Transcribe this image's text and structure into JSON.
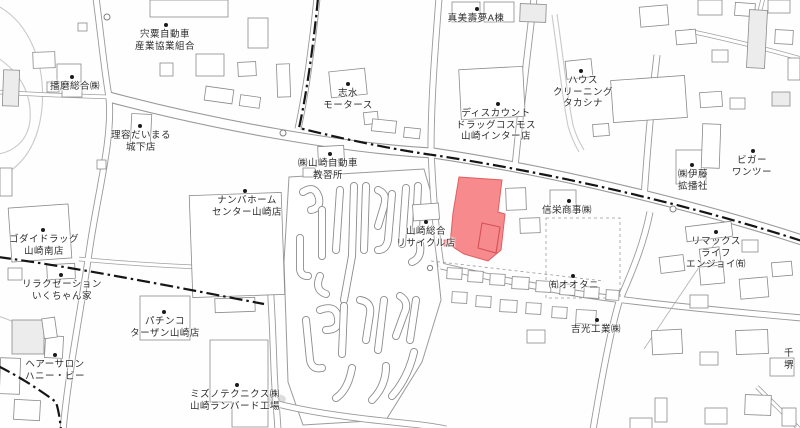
{
  "map": {
    "highlight_color": "#f78a8c",
    "highlight_stroke": "#de6062",
    "labels": [
      {
        "id": "shiso-jidosha",
        "lines": [
          "宍粟自動車",
          "産業協業組合"
        ],
        "x": 165,
        "y": 25,
        "dot": {
          "x": 166,
          "y": 25
        }
      },
      {
        "id": "harima-sogo",
        "lines": [
          "播磨総合㈱"
        ],
        "x": 75,
        "y": 78,
        "dot": {
          "x": 72,
          "y": 77
        }
      },
      {
        "id": "mami-jumu-a",
        "lines": [
          "真美壽夢A棟"
        ],
        "x": 476,
        "y": 10,
        "dot": {
          "x": 477,
          "y": 9
        }
      },
      {
        "id": "shimizu-motors",
        "lines": [
          "志水",
          "モータース"
        ],
        "x": 348,
        "y": 85,
        "dot": {
          "x": 348,
          "y": 84
        }
      },
      {
        "id": "house-cleaning-takashina",
        "lines": [
          "ハウス",
          "クリーニング",
          "タカシナ"
        ],
        "x": 583,
        "y": 72,
        "dot": {
          "x": 581,
          "y": 71
        }
      },
      {
        "id": "discount-drug-cosmos",
        "lines": [
          "ディスカウント",
          "ドラッグコスモス",
          "山崎インター店"
        ],
        "x": 496,
        "y": 105,
        "dot": {
          "x": 498,
          "y": 104
        }
      },
      {
        "id": "vigor-one-two",
        "lines": [
          "ビガー",
          "ワンツー"
        ],
        "x": 752,
        "y": 152,
        "dot": {
          "x": 753,
          "y": 151
        }
      },
      {
        "id": "ito-kakuhansha",
        "lines": [
          "㈱伊藤",
          "拡播社"
        ],
        "x": 693,
        "y": 166,
        "dot": {
          "x": 692,
          "y": 165
        }
      },
      {
        "id": "riyo-daimaru",
        "lines": [
          "理容だいまる",
          "城下店"
        ],
        "x": 141,
        "y": 127,
        "dot": {
          "x": 140,
          "y": 126
        }
      },
      {
        "id": "yamasaki-driving-school",
        "lines": [
          "㈱山崎自動車",
          "教習所"
        ],
        "x": 328,
        "y": 155,
        "dot": {
          "x": 330,
          "y": 154
        }
      },
      {
        "id": "namba-home-center",
        "lines": [
          "ナンバホーム",
          "センター山崎店"
        ],
        "x": 247,
        "y": 192,
        "dot": {
          "x": 245,
          "y": 191
        }
      },
      {
        "id": "godai-drug",
        "lines": [
          "ゴダイドラッグ",
          "山崎南店"
        ],
        "x": 44,
        "y": 231,
        "dot": {
          "x": 43,
          "y": 230
        }
      },
      {
        "id": "yamasaki-sogo-recycle",
        "lines": [
          "山崎総合",
          "リサイクル店"
        ],
        "x": 426,
        "y": 223,
        "dot": {
          "x": 426,
          "y": 222
        }
      },
      {
        "id": "shinei-shoji",
        "lines": [
          "信栄商事㈱"
        ],
        "x": 567,
        "y": 202,
        "dot": {
          "x": 569,
          "y": 201
        }
      },
      {
        "id": "remax-life-enjoy",
        "lines": [
          "リマックス",
          "ライフ",
          "エンジョイ㈲"
        ],
        "x": 716,
        "y": 233,
        "dot": {
          "x": 716,
          "y": 232
        }
      },
      {
        "id": "relaxation-ikuchanchi",
        "lines": [
          "リラクゼーション",
          "いくちゃん家"
        ],
        "x": 62,
        "y": 276,
        "dot": {
          "x": 61,
          "y": 275
        }
      },
      {
        "id": "otani",
        "lines": [
          "㈲オオタニ"
        ],
        "x": 574,
        "y": 277,
        "dot": {
          "x": 573,
          "y": 276
        }
      },
      {
        "id": "pachinko-tarzan",
        "lines": [
          "パチンコ",
          "ターザン山崎店"
        ],
        "x": 165,
        "y": 313,
        "dot": {
          "x": 164,
          "y": 312
        }
      },
      {
        "id": "hair-salon-honey-bee",
        "lines": [
          "ヘアーサロン",
          "ハニー・ビー"
        ],
        "x": 55,
        "y": 356,
        "dot": {
          "x": 55,
          "y": 355
        }
      },
      {
        "id": "yoshimitsu-kogyo",
        "lines": [
          "吉光工業㈱"
        ],
        "x": 596,
        "y": 321,
        "dot": {
          "x": 597,
          "y": 320
        }
      },
      {
        "id": "mizuno-technics",
        "lines": [
          "ミズノテクニクス㈱",
          "山崎ランバード工場"
        ],
        "x": 235,
        "y": 386,
        "dot": {
          "x": 237,
          "y": 385
        }
      },
      {
        "id": "sen-sakai-partial",
        "lines": [
          "千",
          "堺"
        ],
        "x": 789,
        "y": 348,
        "dot": null
      }
    ]
  }
}
